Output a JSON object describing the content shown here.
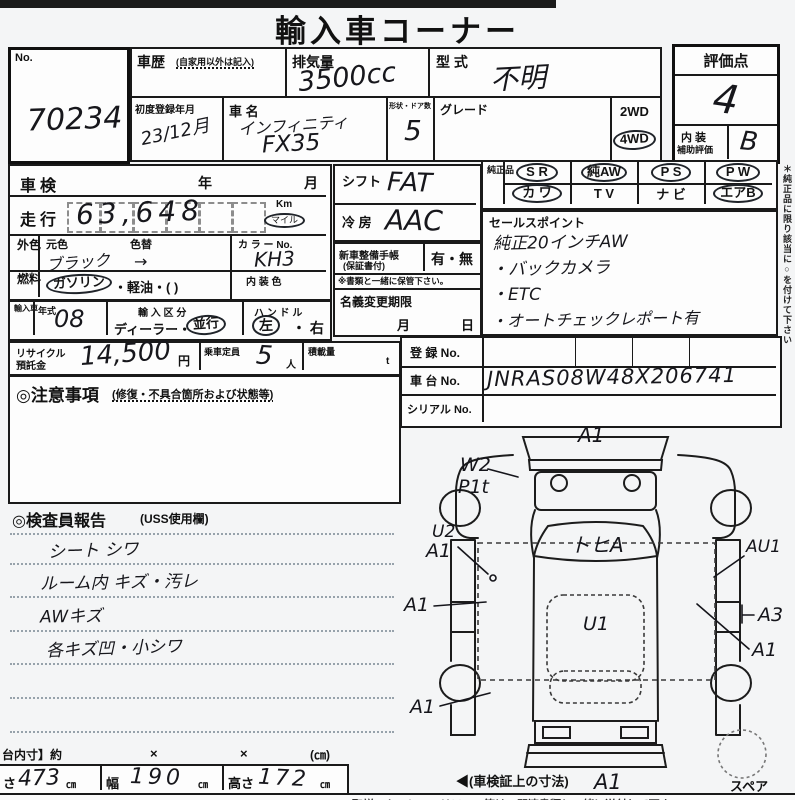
{
  "title": "輸入車コーナー",
  "no_box": {
    "label": "No.",
    "value": "70234"
  },
  "header": {
    "history_label": "車歴",
    "history_note": "(自家用以外は記入)",
    "displacement_label": "排気量",
    "displacement_value": "3500cc",
    "model_code_label": "型 式",
    "model_code_value": "不明",
    "first_reg_label": "初度登録年月",
    "first_reg_value": "23/12月",
    "car_name_label": "車 名",
    "car_name_line1": "インフィニティ",
    "car_name_line2": "FX35",
    "shape_doors_label": "形状・ドア数",
    "shape_doors_value": "5",
    "grade_label": "グレード",
    "wd2": "2WD",
    "wd4": "4WD",
    "drive_selected": "4WD"
  },
  "score": {
    "label": "評価点",
    "value": "4",
    "interior_label_1": "内 装",
    "interior_label_2": "補助評価",
    "interior_value": "B"
  },
  "shaken": {
    "label": "車検",
    "year": "年",
    "month": "月"
  },
  "mileage": {
    "label": "走行",
    "value": "63,648",
    "unit_km": "Km",
    "unit_mile": "マイル",
    "unit_selected": "マイル"
  },
  "exterior": {
    "label": "外色",
    "orig_label": "元色",
    "orig_value": "ブラック",
    "arrow": "→",
    "change_label": "色替",
    "color_no_label": "カ ラ ー No.",
    "color_no_value": "KH3",
    "interior_color_label": "内 装 色"
  },
  "fuel": {
    "label": "燃料",
    "opt_selected": "ガソリン",
    "opt_rest": "・軽油・(            )"
  },
  "import_row": {
    "side_label": "輸入車",
    "year_label": "年式",
    "year_value": "08",
    "division_label": "輸 入 区 分",
    "division_prefix": "ディーラー・",
    "division_selected": "並行",
    "handle_label": "ハ ン ド ル",
    "handle_selected": "左",
    "handle_rest": "・ 右"
  },
  "recycle": {
    "label_1": "リサイクル",
    "label_2": "預託金",
    "value": "14,500",
    "unit": "円",
    "capacity_label": "乗車定員",
    "capacity_value": "5",
    "capacity_unit": "人",
    "load_label": "積載量",
    "load_unit": "t"
  },
  "caution": {
    "title": "◎注意事項",
    "note": "(修復・不具合箇所および状態等)"
  },
  "inspector": {
    "title": "◎検査員報告",
    "note": "(USS使用欄)",
    "lines": [
      "シート シワ",
      "ルーム内 キズ・汚レ",
      "AWキズ",
      "各キズ凹・小シワ"
    ]
  },
  "shift": {
    "label": "シフト",
    "value": "FAT"
  },
  "ac": {
    "label": "冷 房",
    "value": "AAC"
  },
  "maintenance": {
    "label_1": "新車整備手帳",
    "label_2": "(保証書付)",
    "options": "有・無",
    "note": "※書類と一緒に保管下さい。"
  },
  "transfer": {
    "label": "名義変更期限",
    "month": "月",
    "day": "日"
  },
  "options_grid": {
    "side_label": "純正品",
    "row1": [
      "S R",
      "純AW",
      "P S",
      "P W"
    ],
    "row2": [
      "カ ワ",
      "T V",
      "ナ ビ",
      "エアB"
    ],
    "circled": [
      "S R",
      "純AW",
      "P S",
      "P W",
      "カ ワ",
      "エアB"
    ]
  },
  "sales": {
    "label": "セールスポイント",
    "lines": [
      "純正20インチAW",
      "・バックカメラ",
      "・ETC",
      "・オートチェックレポート有"
    ]
  },
  "registration": {
    "reg_label": "登 録 No.",
    "chassis_label": "車 台 No.",
    "chassis_value": "JNRAS08W48X206741",
    "serial_label": "シリアル No."
  },
  "side_note": "＊純正品に限り該当に○を付けて下さい",
  "diagram": {
    "front_bumper": "A1",
    "left_fender_1": "W2",
    "left_fender_2": "P1t",
    "left_door_1": "U2",
    "left_door_2": "A1",
    "left_mid": "A1",
    "left_rear": "A1",
    "windshield": "トヒA",
    "roof": "U1",
    "right_door": "AU1",
    "right_quarter": "A3",
    "right_rear": "A1",
    "rear_bumper": "A1",
    "spare_label": "スペア",
    "dims_note": "◀(車検証上の寸法)"
  },
  "dimensions": {
    "row_label": "台内寸】約",
    "x1": "×",
    "x2": "×",
    "unit": "(㎝)",
    "length_label": "さ",
    "length_value": "473",
    "length_unit": "㎝",
    "width_label": "幅",
    "width_value": "190",
    "width_unit": "㎝",
    "height_label": "高さ",
    "height_value": "172",
    "height_unit": "㎝"
  },
  "footer_note": "取説・キーレス・リモコン等は、関連書類と一緒に送付して下さい"
}
